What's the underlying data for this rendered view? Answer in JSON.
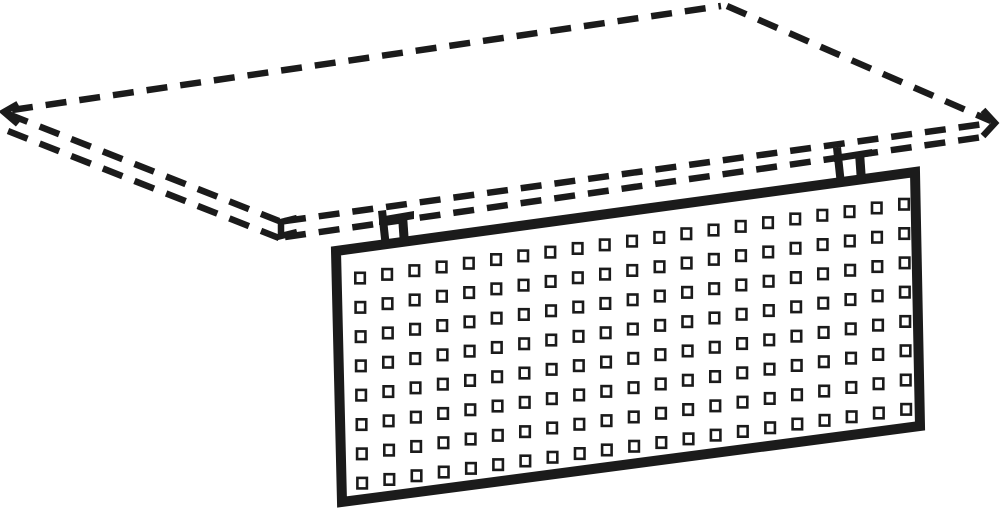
{
  "figure": {
    "kind": "technical-line-drawing",
    "subject": "perforated-panel-mounted-under-table-top",
    "canvas": {
      "width": 1000,
      "height": 517,
      "background_color": "#ffffff",
      "line_color": "#1b1b1b"
    },
    "tabletop": {
      "name": "tabletop-hidden-outline",
      "line_style": "dashed",
      "stroke_width": 6.5,
      "dash_pattern": [
        21,
        13
      ],
      "edges": [
        {
          "name": "tabletop-back-left-edge",
          "points": [
            12,
            110,
            721,
            6
          ]
        },
        {
          "name": "tabletop-back-right-edge",
          "points": [
            727,
            6,
            991,
            121
          ]
        },
        {
          "name": "tabletop-front-left-top-edge",
          "points": [
            8,
            114,
            279,
            221
          ]
        },
        {
          "name": "tabletop-front-left-bottom-edge",
          "points": [
            8,
            131,
            279,
            238
          ]
        },
        {
          "name": "tabletop-front-right-top-edge",
          "points": [
            285,
            221,
            991,
            123
          ]
        },
        {
          "name": "tabletop-front-right-bottom-edge",
          "points": [
            285,
            237,
            983,
            137
          ]
        }
      ],
      "corner_marks": [
        {
          "name": "tabletop-left-corner-mark",
          "points": "18,104 4,112 18,124"
        },
        {
          "name": "tabletop-front-corner-mark",
          "points": "297,218 281,222 281,236 297,232"
        },
        {
          "name": "tabletop-right-corner-mark",
          "points": "983,110 995,123 983,136"
        }
      ]
    },
    "panel": {
      "name": "perforated-panel",
      "outline_points": "336,251 915,172 920,426 342,502",
      "stroke_width": 10,
      "fill_color": "#ffffff",
      "holes": {
        "rows": 8,
        "cols": 21,
        "origin_x": 360,
        "origin_y": 278,
        "col_step": 27.2,
        "row_step": 29.3,
        "row_slope": -0.1356,
        "col_drift_per_row": 0.3,
        "hole_width": 9.5,
        "hole_height": 10.5,
        "stroke_width": 2.6,
        "fill_color": "#ffffff"
      }
    },
    "brackets": [
      {
        "name": "left-mounting-bracket",
        "parts": [
          "379,217 414,211 414,219 379,225",
          "378,211 386,210 390,247 382,248",
          "398,216 407,215 409,244 400,245"
        ]
      },
      {
        "name": "right-mounting-bracket",
        "parts": [
          "834,155 872,149 872,156 834,162",
          "833,148 841,147 845,184 837,185",
          "855,153 864,152 866,181 857,182"
        ]
      }
    ]
  }
}
